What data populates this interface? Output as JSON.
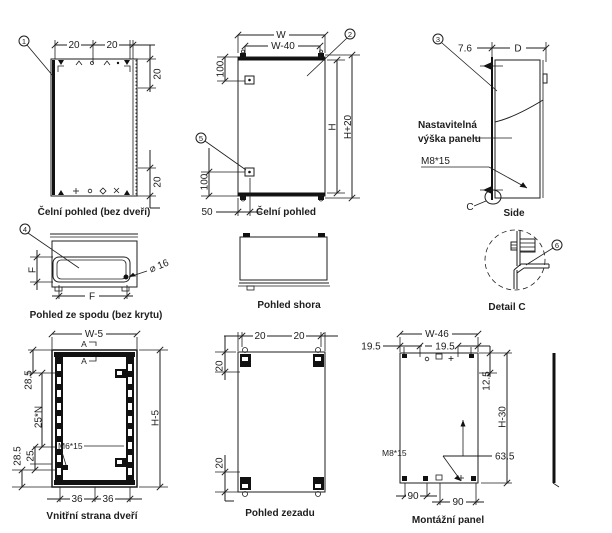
{
  "colors": {
    "line": "#1d1d1d",
    "background": "#ffffff",
    "text": "#1d1d1d"
  },
  "views": {
    "front_no_door": {
      "caption": "Čelní pohled (bez dveří)",
      "balloon": "1",
      "dim_top_left": "20",
      "dim_top_right": "20",
      "dim_side_top": "20",
      "dim_side_bottom": "20"
    },
    "front": {
      "caption": "Čelní pohled",
      "balloon_body": "2",
      "balloon_stud": "5",
      "dim_width": "W",
      "dim_width_inner": "W-40",
      "dim_stud_top": "100",
      "dim_stud_bottom": "100",
      "dim_stud_offset": "50",
      "dim_height": "H",
      "dim_height_total": "H+20"
    },
    "side": {
      "caption": "Side",
      "balloon": "3",
      "dim_front_offset": "7.6",
      "dim_depth": "D",
      "panel_note_line1": "Nastavitelná",
      "panel_note_line2": "výška panelu",
      "stud_label": "M8*15",
      "detail_ref": "C"
    },
    "bottom_no_cover": {
      "caption": "Pohled ze spodu (bez krytu)",
      "balloon": "4",
      "dim_depth": "F",
      "dim_width": "F",
      "hole_label": "⌀ 16"
    },
    "top_view": {
      "caption": "Pohled shora"
    },
    "detail_c": {
      "caption": "Detail C",
      "balloon": "6"
    },
    "door": {
      "caption": "Vnitřní strana dveří",
      "dim_width": "W-5",
      "dim_height": "H-5",
      "dim_top": "28.5",
      "dim_pitch": "25*N",
      "dim_step": "25",
      "dim_bottom": "28.5",
      "dim_hinge_left": "36",
      "dim_hinge_right": "36",
      "stud_label": "M6*15",
      "section_mark": "A"
    },
    "rear": {
      "caption": "Pohled zezadu",
      "dim_top_left": "20",
      "dim_top_right": "20",
      "dim_side_top": "20",
      "dim_side_bottom": "20"
    },
    "mounting_panel": {
      "caption": "Montážní panel",
      "dim_width": "W-46",
      "dim_left": "19.5",
      "dim_right": "19.5",
      "dim_top_offset": "12.5",
      "dim_height": "H-30",
      "dim_mid": "63.5",
      "dim_bottom_left": "90",
      "dim_bottom_right": "90",
      "stud_label": "M8*15"
    }
  }
}
